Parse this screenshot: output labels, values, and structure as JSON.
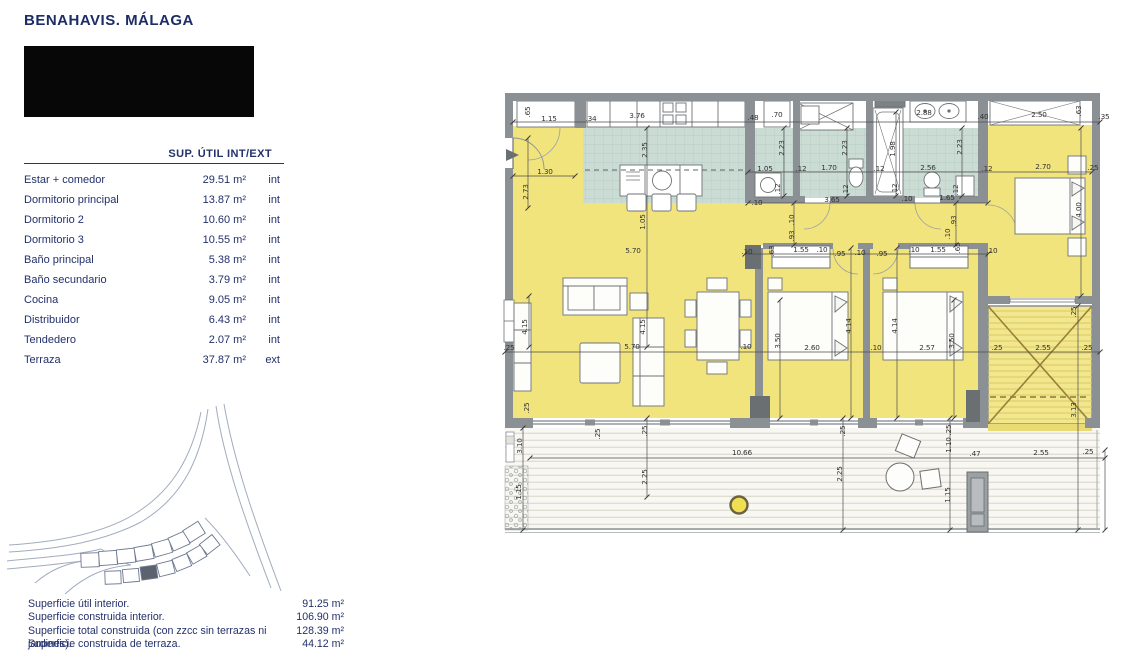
{
  "header": {
    "location_title": "BENAHAVIS. MÁLAGA"
  },
  "area_table": {
    "header": "SUP. ÚTIL INT/EXT",
    "rows": [
      {
        "label": "Estar + comedor",
        "value": "29.51 m²",
        "type": "int"
      },
      {
        "label": "Dormitorio principal",
        "value": "13.87 m²",
        "type": "int"
      },
      {
        "label": "Dormitorio 2",
        "value": "10.60 m²",
        "type": "int"
      },
      {
        "label": "Dormitorio 3",
        "value": "10.55 m²",
        "type": "int"
      },
      {
        "label": "Baño principal",
        "value": "5.38 m²",
        "type": "int"
      },
      {
        "label": "Baño secundario",
        "value": "3.79 m²",
        "type": "int"
      },
      {
        "label": "Cocina",
        "value": "9.05 m²",
        "type": "int"
      },
      {
        "label": "Distribuidor",
        "value": "6.43 m²",
        "type": "int"
      },
      {
        "label": "Tendedero",
        "value": "2.07 m²",
        "type": "int"
      },
      {
        "label": "Terraza",
        "value": "37.87 m²",
        "type": "ext"
      }
    ]
  },
  "summary": {
    "rows": [
      {
        "label": "Superficie útil interior.",
        "value": "91.25 m²"
      },
      {
        "label": "Superficie construida interior.",
        "value": "106.90 m²"
      },
      {
        "label": "Superficie total construida (con zzcc sin terrazas ni jardines).",
        "value": "128.39 m²"
      },
      {
        "label": "Superficie construida de terraza.",
        "value": "44.12 m²"
      }
    ]
  },
  "floor_plan": {
    "colors": {
      "room_yellow": "#f1e47d",
      "wet_teal": "#cbdcd5",
      "wall_gray": "#8b9094",
      "hatch_yellow": "#f1e78f",
      "accent_navy": "#1d2d66"
    },
    "dimension_labels": [
      {
        "t": ".65",
        "x": 530,
        "y": 112,
        "r": -90
      },
      {
        "t": "1.15",
        "x": 549,
        "y": 121,
        "r": 0
      },
      {
        "t": ".34",
        "x": 591,
        "y": 121,
        "r": 0
      },
      {
        "t": "3.76",
        "x": 637,
        "y": 118,
        "r": 0
      },
      {
        "t": ".48",
        "x": 753,
        "y": 120,
        "r": 0
      },
      {
        "t": ".70",
        "x": 777,
        "y": 117,
        "r": 0
      },
      {
        "t": "2.88",
        "x": 924,
        "y": 115,
        "r": 0
      },
      {
        "t": ".40",
        "x": 983,
        "y": 119,
        "r": 0
      },
      {
        "t": "2.50",
        "x": 1039,
        "y": 117,
        "r": 0
      },
      {
        "t": ".63",
        "x": 1081,
        "y": 111,
        "r": -90
      },
      {
        "t": ".35",
        "x": 1104,
        "y": 119,
        "r": 0
      },
      {
        "t": "1.30",
        "x": 545,
        "y": 174,
        "r": 0
      },
      {
        "t": "2.73",
        "x": 528,
        "y": 192,
        "r": -90
      },
      {
        "t": "2.35",
        "x": 647,
        "y": 150,
        "r": -90
      },
      {
        "t": "1.05",
        "x": 645,
        "y": 222,
        "r": -90
      },
      {
        "t": "5.70",
        "x": 633,
        "y": 253,
        "r": 0
      },
      {
        "t": "4.15",
        "x": 527,
        "y": 327,
        "r": -90
      },
      {
        "t": "4.15",
        "x": 645,
        "y": 327,
        "r": -90
      },
      {
        "t": ".25",
        "x": 509,
        "y": 350,
        "r": 0
      },
      {
        "t": "5.70",
        "x": 632,
        "y": 349,
        "r": 0
      },
      {
        "t": ".10",
        "x": 746,
        "y": 349,
        "r": 0
      },
      {
        "t": "1.05",
        "x": 765,
        "y": 171,
        "r": 0
      },
      {
        "t": ".12",
        "x": 801,
        "y": 171,
        "r": 0
      },
      {
        "t": "1.70",
        "x": 829,
        "y": 170,
        "r": 0
      },
      {
        "t": ".12",
        "x": 879,
        "y": 171,
        "r": 0
      },
      {
        "t": "2.56",
        "x": 928,
        "y": 170,
        "r": 0
      },
      {
        "t": ".12",
        "x": 987,
        "y": 171,
        "r": 0
      },
      {
        "t": "2.70",
        "x": 1043,
        "y": 169,
        "r": 0
      },
      {
        "t": ".25",
        "x": 1093,
        "y": 170,
        "r": 0
      },
      {
        "t": "2.23",
        "x": 784,
        "y": 148,
        "r": -90
      },
      {
        "t": "2.23",
        "x": 847,
        "y": 148,
        "r": -90
      },
      {
        "t": "1.98",
        "x": 895,
        "y": 149,
        "r": -90
      },
      {
        "t": "2.23",
        "x": 962,
        "y": 147,
        "r": -90
      },
      {
        "t": ".12",
        "x": 780,
        "y": 189,
        "r": -90
      },
      {
        "t": ".12",
        "x": 848,
        "y": 190,
        "r": -90
      },
      {
        "t": ".12",
        "x": 897,
        "y": 189,
        "r": -90
      },
      {
        "t": ".12",
        "x": 958,
        "y": 190,
        "r": -90
      },
      {
        "t": "4.00",
        "x": 1081,
        "y": 210,
        "r": -90
      },
      {
        "t": "3.65",
        "x": 832,
        "y": 202,
        "r": 0
      },
      {
        "t": ".10",
        "x": 757,
        "y": 205,
        "r": 0
      },
      {
        "t": ".10",
        "x": 907,
        "y": 201,
        "r": 0
      },
      {
        "t": "1.65",
        "x": 947,
        "y": 200,
        "r": 0
      },
      {
        "t": ".10",
        "x": 794,
        "y": 220,
        "r": -90
      },
      {
        "t": ".93",
        "x": 794,
        "y": 236,
        "r": -90
      },
      {
        "t": ".93",
        "x": 956,
        "y": 221,
        "r": -90
      },
      {
        "t": ".10",
        "x": 950,
        "y": 234,
        "r": -90
      },
      {
        "t": ".10",
        "x": 747,
        "y": 254,
        "r": 0
      },
      {
        "t": ".63",
        "x": 774,
        "y": 251,
        "r": -90
      },
      {
        "t": "1.55",
        "x": 801,
        "y": 252,
        "r": 0
      },
      {
        "t": ".10",
        "x": 822,
        "y": 252,
        "r": 0
      },
      {
        "t": ".95",
        "x": 840,
        "y": 256,
        "r": 0
      },
      {
        "t": ".10",
        "x": 860,
        "y": 255,
        "r": 0
      },
      {
        "t": ".95",
        "x": 882,
        "y": 256,
        "r": 0
      },
      {
        "t": ".10",
        "x": 914,
        "y": 252,
        "r": 0
      },
      {
        "t": "1.55",
        "x": 938,
        "y": 252,
        "r": 0
      },
      {
        "t": ".65",
        "x": 960,
        "y": 248,
        "r": -90
      },
      {
        "t": ".10",
        "x": 992,
        "y": 253,
        "r": 0
      },
      {
        "t": "4.14",
        "x": 851,
        "y": 326,
        "r": -90
      },
      {
        "t": "4.14",
        "x": 897,
        "y": 326,
        "r": -90
      },
      {
        "t": "3.50",
        "x": 780,
        "y": 341,
        "r": -90
      },
      {
        "t": "3.50",
        "x": 954,
        "y": 341,
        "r": -90
      },
      {
        "t": "2.60",
        "x": 812,
        "y": 350,
        "r": 0
      },
      {
        "t": ".10",
        "x": 876,
        "y": 350,
        "r": 0
      },
      {
        "t": "2.57",
        "x": 927,
        "y": 350,
        "r": 0
      },
      {
        "t": ".25",
        "x": 997,
        "y": 350,
        "r": 0
      },
      {
        "t": "2.55",
        "x": 1043,
        "y": 350,
        "r": 0
      },
      {
        "t": ".25",
        "x": 1087,
        "y": 350,
        "r": 0
      },
      {
        "t": ".25",
        "x": 1076,
        "y": 312,
        "r": -90
      },
      {
        "t": "3.13",
        "x": 1076,
        "y": 410,
        "r": -90
      },
      {
        "t": ".25",
        "x": 529,
        "y": 408,
        "r": -90
      },
      {
        "t": "3.10",
        "x": 522,
        "y": 446,
        "r": -90
      },
      {
        "t": "1.15",
        "x": 521,
        "y": 492,
        "r": -90
      },
      {
        "t": ".25",
        "x": 600,
        "y": 434,
        "r": -90
      },
      {
        "t": ".25",
        "x": 647,
        "y": 431,
        "r": -90
      },
      {
        "t": "2.25",
        "x": 647,
        "y": 477,
        "r": -90
      },
      {
        "t": "10.66",
        "x": 742,
        "y": 455,
        "r": 0
      },
      {
        "t": ".25",
        "x": 845,
        "y": 431,
        "r": -90
      },
      {
        "t": "2.25",
        "x": 842,
        "y": 474,
        "r": -90
      },
      {
        "t": ".25",
        "x": 951,
        "y": 430,
        "r": -90
      },
      {
        "t": "1.10",
        "x": 951,
        "y": 445,
        "r": -90
      },
      {
        "t": ".47",
        "x": 975,
        "y": 456,
        "r": 0
      },
      {
        "t": "2.55",
        "x": 1041,
        "y": 455,
        "r": 0
      },
      {
        "t": ".25",
        "x": 1088,
        "y": 454,
        "r": 0
      },
      {
        "t": "1.15",
        "x": 950,
        "y": 495,
        "r": -90
      }
    ]
  }
}
